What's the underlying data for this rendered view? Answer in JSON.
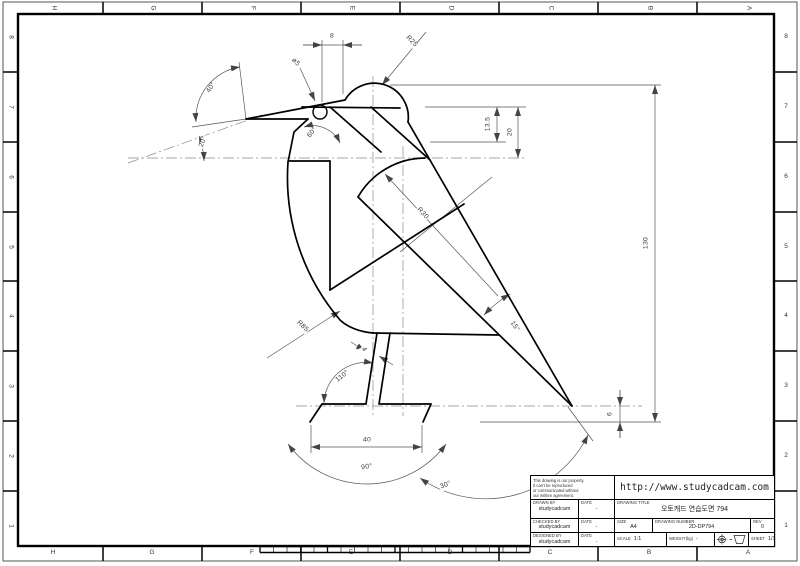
{
  "sheet": {
    "grid_letters": [
      "H",
      "G",
      "F",
      "E",
      "D",
      "C",
      "B",
      "A"
    ],
    "grid_numbers": [
      "8",
      "7",
      "6",
      "5",
      "4",
      "3",
      "2",
      "1"
    ]
  },
  "dims": {
    "top_width": "8",
    "head_radius": "R25",
    "eye_dia": "ø5",
    "beak_angle": "40°",
    "beak_incline": "20°",
    "neck_angle": "60°",
    "head_offset": "13.5",
    "head_depth": "20",
    "overall_height": "130",
    "wing_radius": "R30",
    "chest_radius": "R85",
    "tail_angle": "15°",
    "leg_width": "4",
    "leg_angle": "110°",
    "base_width": "40",
    "base_arc": "90°",
    "swing_arc": "30°",
    "tail_drop": "6"
  },
  "title_block": {
    "note_lines": [
      "This drawing is our property.",
      "It can't be reproduced",
      "or communicated without",
      "our written agreement."
    ],
    "url": "http://www.studycadcam.com",
    "drawing_title_label": "DRAWING TITLE",
    "drawing_title": "오토캐드 연습도면 794",
    "drawn_by_label": "DRAWN BY",
    "checked_by_label": "CHECKED BY",
    "designed_by_label": "DESIGNED BY",
    "date_label": "DATE",
    "author": "studycadcam",
    "date_value": "-",
    "size_label": "SIZE",
    "size": "A4",
    "number_label": "DRAWING NUMBER",
    "number": "2D-DP794",
    "rev_label": "REV",
    "rev": "0",
    "scale_label": "SCALE",
    "scale": "1:1",
    "weight_label": "WEIGHT(kg)",
    "weight": "-",
    "sheet_label": "SHEET",
    "sheet": "1/1"
  }
}
